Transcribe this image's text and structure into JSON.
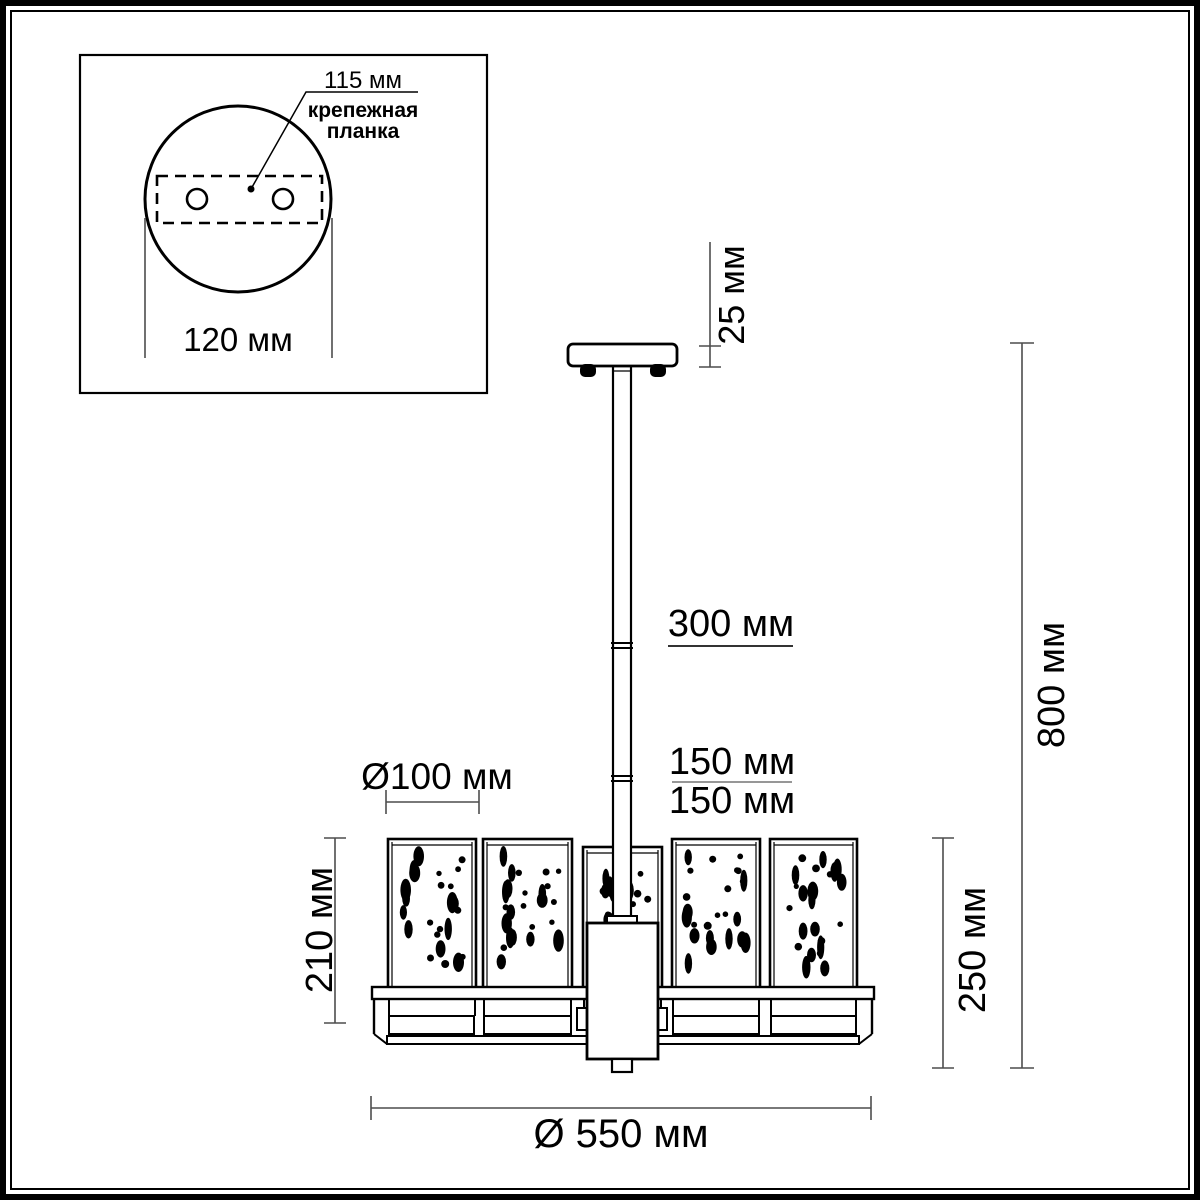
{
  "inset": {
    "hole_pitch_label": "115 мм",
    "plate_label_line1": "крепежная",
    "plate_label_line2": "планка",
    "base_width_label": "120 мм"
  },
  "dims": {
    "canopy_height": "25 мм",
    "rod_section_top": "300 мм",
    "rod_section_mid": "150 мм",
    "rod_section_bottom": "150 мм",
    "total_height": "800 мм",
    "shade_diameter": "Ø100 мм",
    "shade_height": "210 мм",
    "body_height": "250 мм",
    "overall_diameter": "Ø 550 мм"
  },
  "colors": {
    "stroke": "#000000",
    "dim_line": "#4d4d4d",
    "fraction_line": "#888888",
    "background": "#ffffff"
  }
}
